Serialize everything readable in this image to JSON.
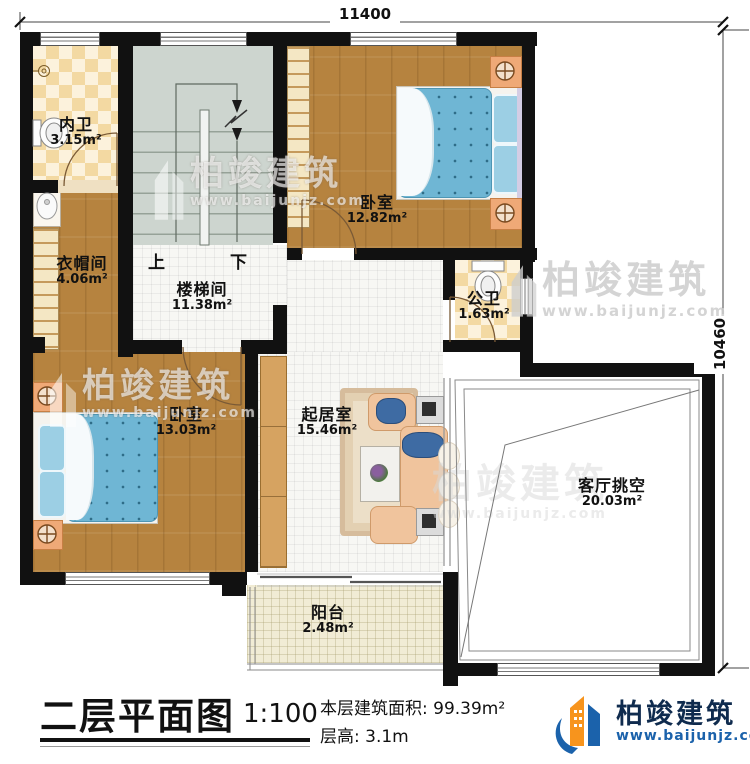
{
  "dimensions": {
    "top": "11400",
    "right": "10460"
  },
  "rooms": [
    {
      "name": "内卫",
      "area": "3.15m²"
    },
    {
      "name": "卧室",
      "area": "12.82m²"
    },
    {
      "name": "衣帽间",
      "area": "4.06m²"
    },
    {
      "name": "楼梯间",
      "area": "11.38m²"
    },
    {
      "name": "公卫",
      "area": "1.63m²"
    },
    {
      "name": "卧室",
      "area": "13.03m²"
    },
    {
      "name": "起居室",
      "area": "15.46m²"
    },
    {
      "name": "客厅挑空",
      "area": "20.03m²"
    },
    {
      "name": "阳台",
      "area": "2.48m²"
    }
  ],
  "stairs": {
    "up": "上",
    "down": "下"
  },
  "title_block": {
    "title": "二层平面图",
    "scale": "1:100",
    "area_label": "本层建筑面积:",
    "area_value": "99.39m²",
    "floor_height_label": "层高:",
    "floor_height_value": "3.1m"
  },
  "brand": {
    "name": "柏竣建筑",
    "website": "www.baijunjz.com"
  },
  "watermark": {
    "name": "柏竣建筑",
    "website": "www.baijunjz.com"
  },
  "colors": {
    "wall": "#111111",
    "wood": "#b6833f",
    "tile_checker": "#f3d9a2",
    "stair": "#cdd5cf",
    "bed": "#6fb6d4",
    "brand_orange": "#f7941d",
    "brand_blue": "#1b62ab"
  }
}
